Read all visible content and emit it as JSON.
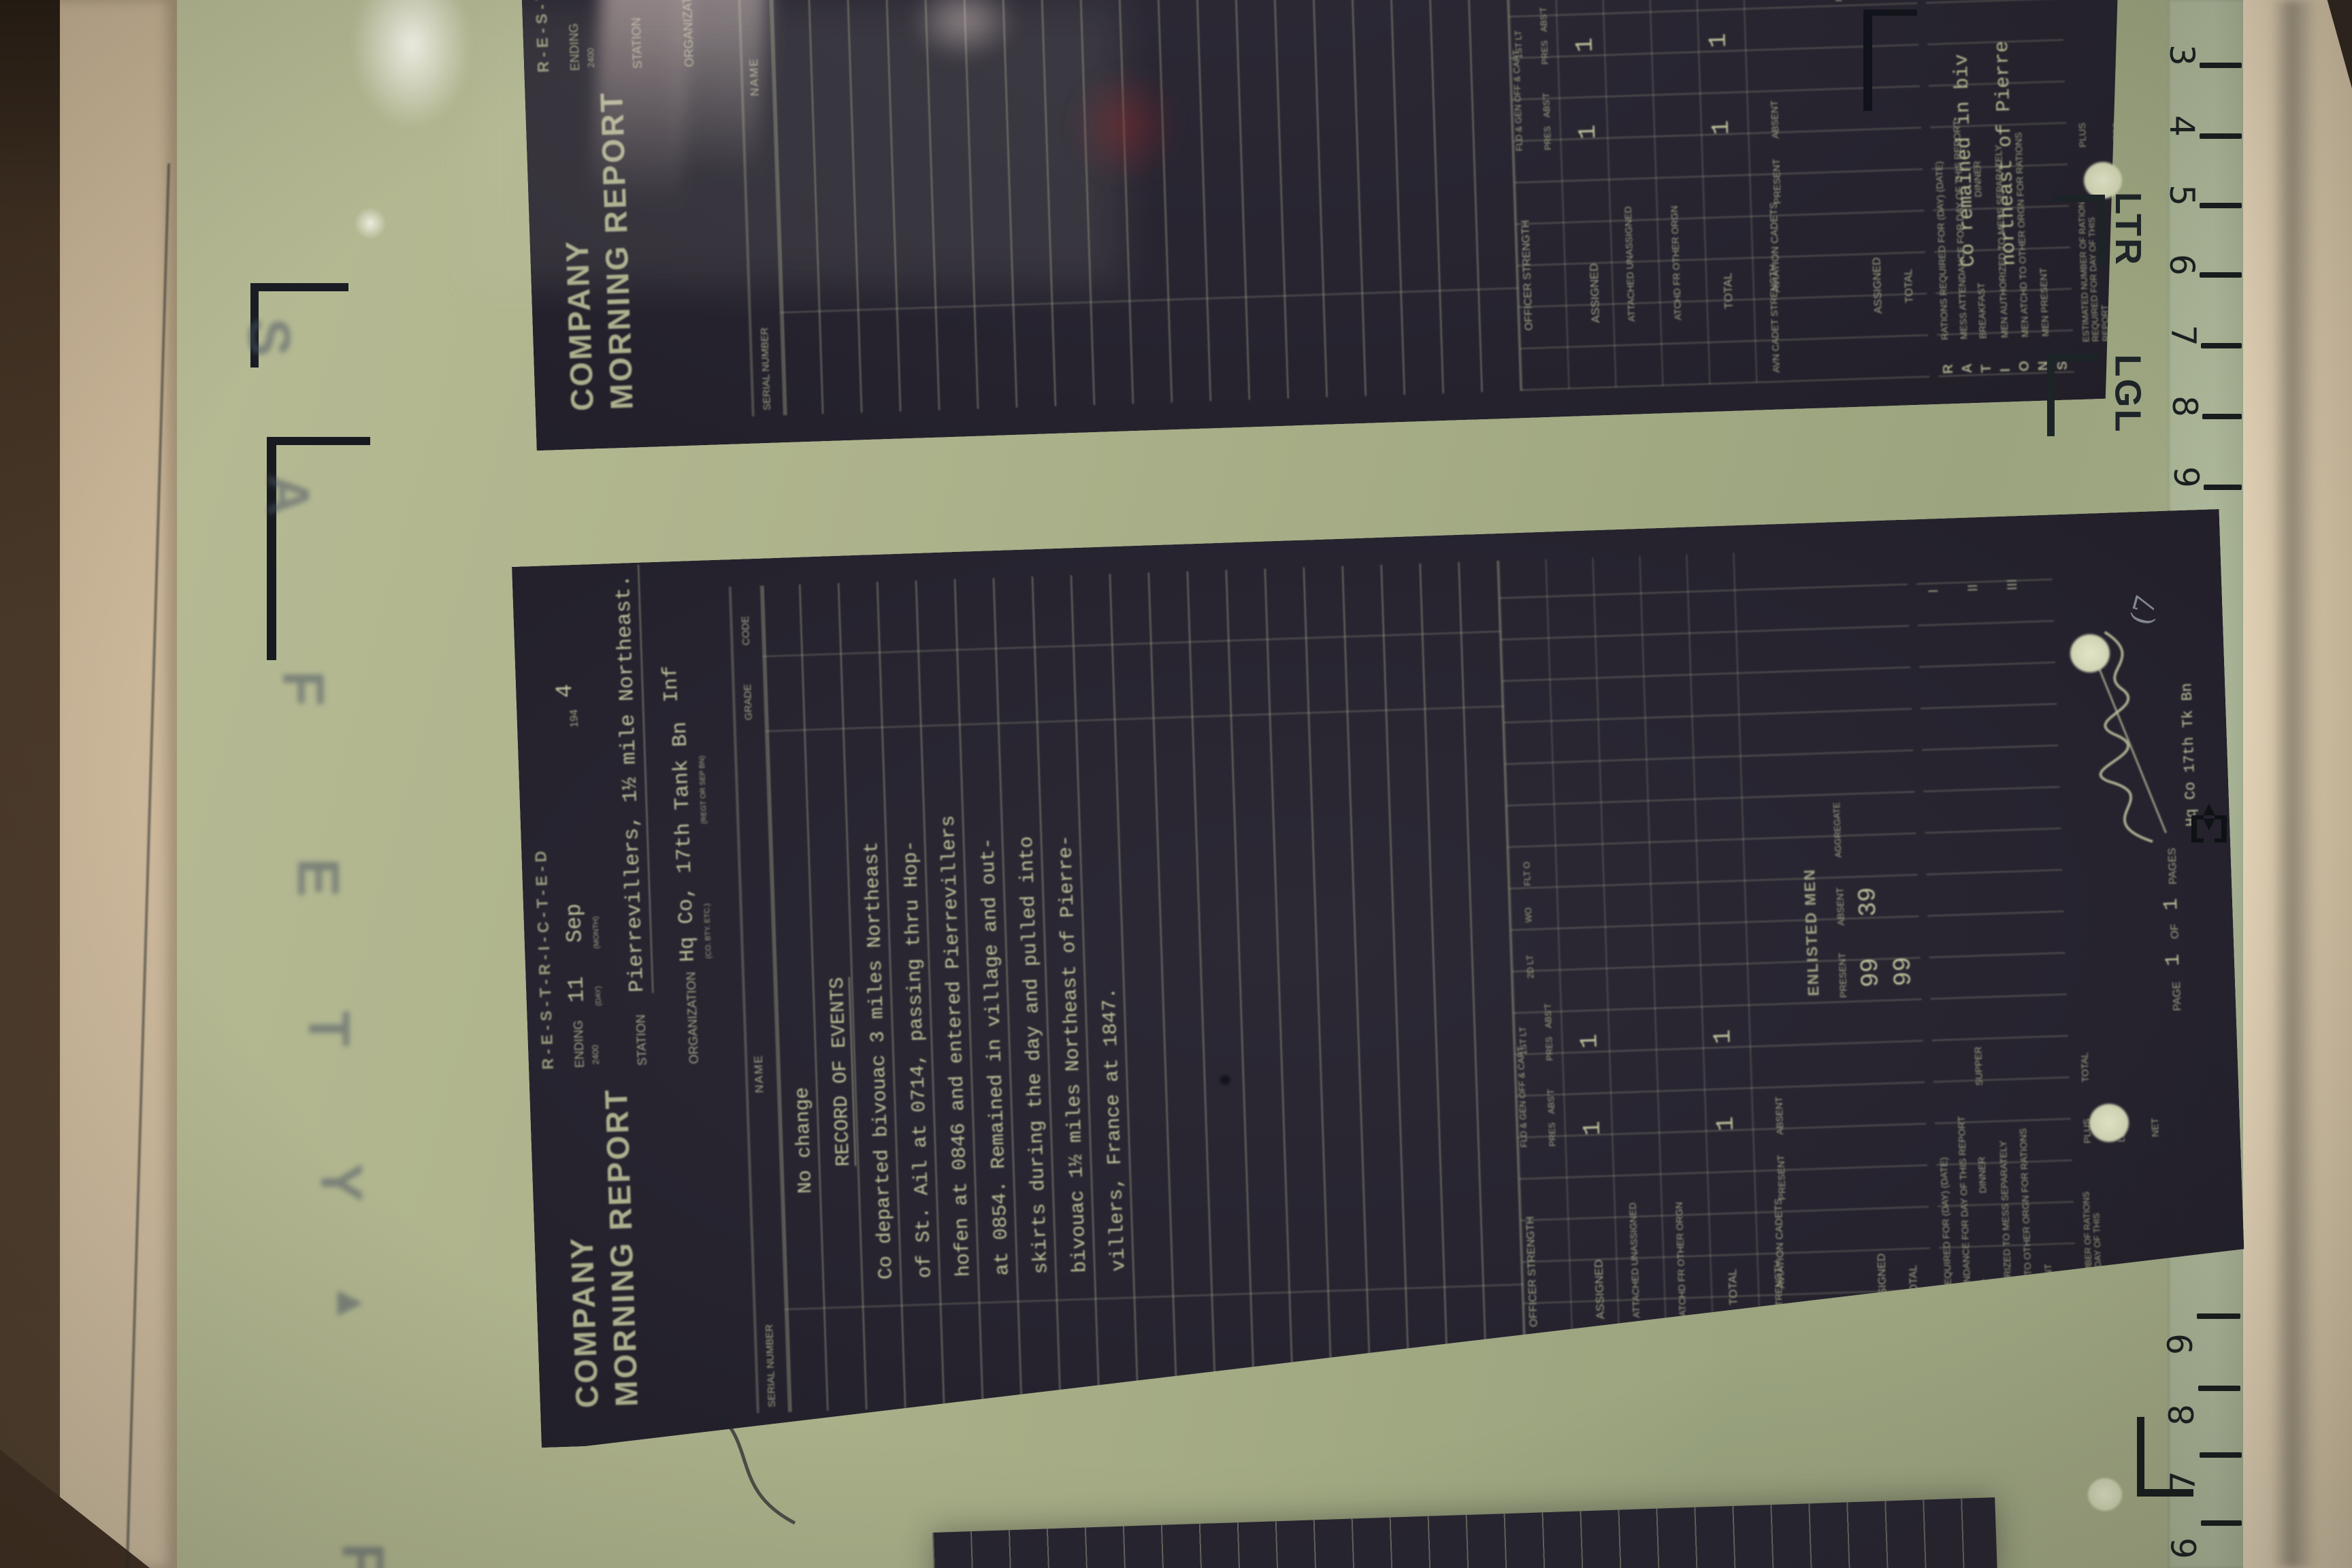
{
  "reader": {
    "safety_letters": [
      "S",
      "A",
      "F",
      "E",
      "T",
      "Y"
    ],
    "arrow_mark": "▲",
    "partial_letter": "F",
    "ruler_top": [
      "3",
      "4",
      "5",
      "6",
      "7",
      "8",
      "9"
    ],
    "ruler_bottom": [
      "9",
      "8",
      "7",
      "6"
    ],
    "mark_letter": "LTR",
    "mark_legal": "LGL"
  },
  "form_labels": {
    "restricted_code": "R-E-S-T-R-I-C-T-E-D",
    "title_line1": "COMPANY",
    "title_line2": "MORNING REPORT",
    "ending": "ENDING",
    "ending_hour": "2400",
    "day_label": "(DAY)",
    "month_label": "(MONTH)",
    "year_prefix": "194",
    "station": "STATION",
    "organization": "ORGANIZATION",
    "org_sub": "(CO. BTY. ETC.)",
    "org_sub2": "(REGT OR SEP BN)",
    "serial_number": "SERIAL NUMBER",
    "name": "NAME",
    "grade": "GRADE",
    "code": "CODE",
    "officer_strength": "OFFICER STRENGTH",
    "col_fld": "FLD & GEN OFF & CAPT",
    "col_1lt": "1ST LT",
    "col_2lt": "2D LT",
    "col_wo": "WO",
    "col_flto": "FLT O",
    "pres": "PRES",
    "abst": "ABS'T",
    "row_assigned": "ASSIGNED",
    "row_att_unasgd": "ATTACHED UNASSIGNED",
    "row_atchd_other": "ATCHD FR OTHER ORGN",
    "row_total": "TOTAL",
    "avn_cadet_strength": "AVN CADET STRENGTH",
    "aviation_cadets": "AVIATION CADETS",
    "present": "PRESENT",
    "absent": "ABSENT",
    "enlisted_men": "ENLISTED MEN",
    "aggregate": "AGGREGATE",
    "rations_letters": [
      "R",
      "A",
      "T",
      "I",
      "O",
      "N",
      "S"
    ],
    "rations_required": "RATIONS REQUIRED FOR (DAY) (DATE)",
    "mess_attendance": "MESS ATTENDANCE FOR DAY OF THIS REPORT",
    "breakfast": "BREAKFAST",
    "dinner": "DINNER",
    "supper": "SUPPER",
    "men_authorized": "MEN AUTHORIZED TO MESS SEPARATELY",
    "men_atchd": "MEN ATCHD TO OTHER ORGN FOR RATIONS",
    "men_present": "MEN PRESENT",
    "numeral_1": "I",
    "numeral_2": "II",
    "numeral_3": "III",
    "estimated": "ESTIMATED NUMBER OF RATIONS REQUIRED FOR DAY OF THIS REPORT",
    "plus": "PLUS",
    "less": "LESS",
    "net": "NET",
    "total": "TOTAL",
    "page": "PAGE",
    "of": "OF",
    "pages": "PAGES"
  },
  "doc_main": {
    "ending_day": "11",
    "ending_month": "Sep",
    "ending_year": "4",
    "station_value": "Pierrevillers, 1½ mile Northeast.",
    "organization_value": "Hq Co, 17th Tank Bn",
    "org_branch": "Inf",
    "record_lines": [
      "No change",
      "RECORD OF EVENTS",
      "Co departed bivouac 3 miles Northeast",
      "of St. Ail at 0714, passing thru Hop-",
      "hofen at 0846 and entered Pierrevillers",
      "at 0854. Remained in village and out-",
      "skirts during the day and pulled into",
      "bivouac 1½ miles Northeast of Pierre-",
      "villers, France at 1847."
    ],
    "officers_assigned_pres_fld": "1",
    "officers_assigned_pres_1lt": "1",
    "officers_total_pres_fld": "1",
    "officers_total_pres_1lt": "1",
    "enlisted_present": "99",
    "enlisted_absent": "39",
    "enlisted_total": "99",
    "page_no": "1",
    "pages_no": "1",
    "unit_line": "Hq Co 17th Tk Bn",
    "corner_annotation": "(7"
  },
  "doc_top": {
    "station_value": "Pierrevillers, 1½ mile Northeast.",
    "organization_value": "Hq Co, 17th Tank Bn",
    "record_lines": [
      "Co remained in biv",
      "northeast of Pierre"
    ],
    "officers_assigned_pres_fld": "1",
    "officers_assigned_pres_1lt": "1",
    "officers_total_pres_fld": "1",
    "officers_total_pres_1lt": "1"
  }
}
